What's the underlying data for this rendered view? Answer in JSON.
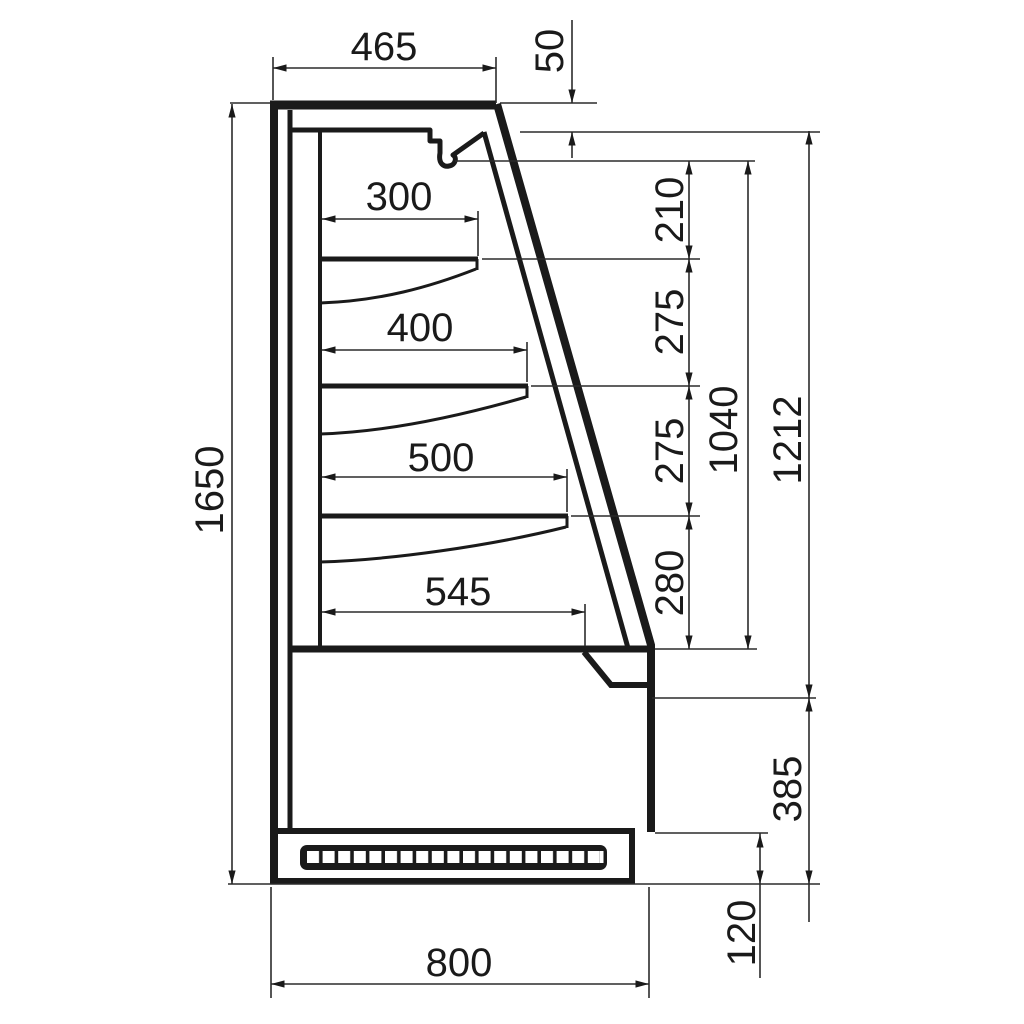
{
  "drawing": {
    "colors": {
      "line": "#1a1a1a",
      "thin_line": "#2b2b2b",
      "background": "#ffffff"
    },
    "dims": {
      "top_depth": "465",
      "canopy_front": "50",
      "shelf1_depth": "300",
      "shelf2_depth": "400",
      "shelf3_depth": "500",
      "deck_depth": "545",
      "gap_canopy_shelf1": "210",
      "gap_shelf1_shelf2": "275",
      "gap_shelf2_shelf3": "275",
      "gap_shelf3_deck": "280",
      "opening_height": "1040",
      "front_height": "1212",
      "lower_front_height": "385",
      "plinth_height": "120",
      "total_height": "1650",
      "base_width": "800"
    }
  }
}
